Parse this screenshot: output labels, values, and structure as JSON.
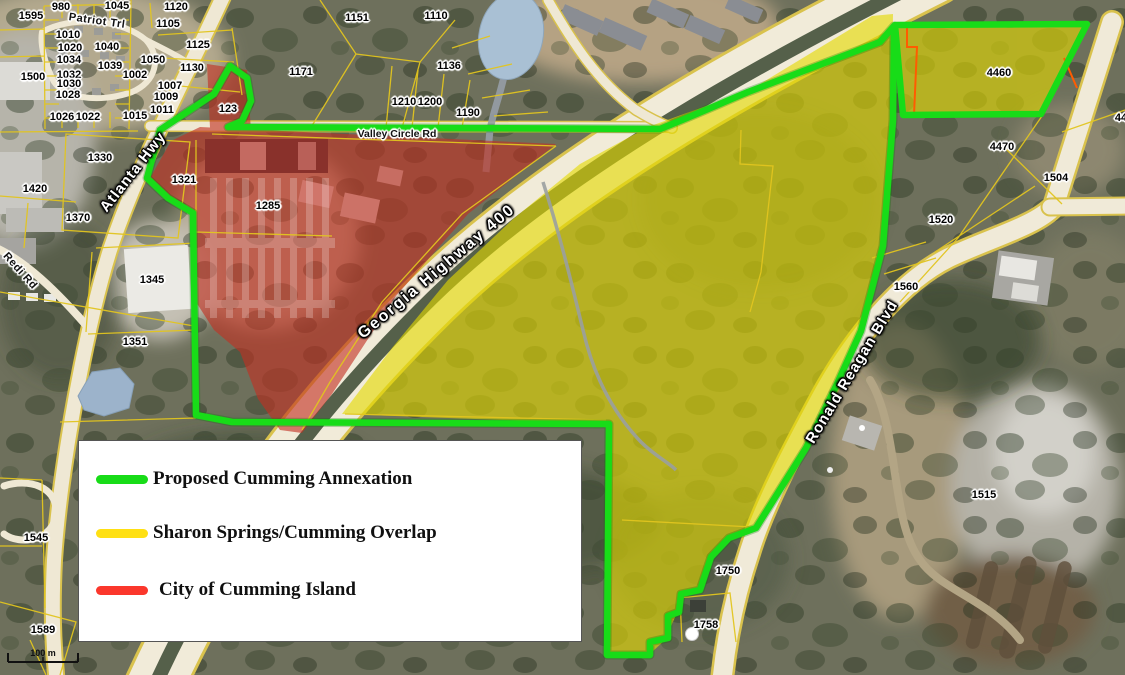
{
  "map": {
    "colors": {
      "annexation_green": "#18dc18",
      "overlap_yellow": "#ffe013",
      "island_red": "#fb372c",
      "overlay_yellow_fill": "#e3da00",
      "overlay_red_fill": "#c23122",
      "island_outline_orange": "#ff5c00",
      "parcel_line": "#e2c51f"
    },
    "legend": {
      "items": [
        {
          "id": "annexation",
          "label": "Proposed Cumming Annexation"
        },
        {
          "id": "overlap",
          "label": "Sharon Springs/Cumming Overlap"
        },
        {
          "id": "island",
          "label": "City of Cumming Island"
        }
      ]
    },
    "scale_bar": {
      "label": "100 m"
    },
    "road_labels": [
      {
        "text": "Atlanta Hwy",
        "x": 133,
        "y": 172,
        "rot": -52,
        "size": 15,
        "style": "light",
        "spacing": 1
      },
      {
        "text": "Georgia Highway 400",
        "x": 437,
        "y": 272,
        "rot": -40,
        "size": 16,
        "style": "light",
        "spacing": 2
      },
      {
        "text": "Ronald Reagan Blvd",
        "x": 852,
        "y": 372,
        "rot": -59,
        "size": 15,
        "style": "light",
        "spacing": 1
      },
      {
        "text": "Valley Circle Rd",
        "x": 397,
        "y": 134,
        "rot": 0,
        "size": 10.5,
        "style": "dark",
        "spacing": 0
      },
      {
        "text": "Patriot Trl",
        "x": 97,
        "y": 21,
        "rot": 8,
        "size": 11,
        "style": "dark",
        "spacing": 0.5
      },
      {
        "text": "Redi Rd",
        "x": 20,
        "y": 271,
        "rot": 48,
        "size": 11,
        "style": "dark",
        "spacing": 0.5
      }
    ],
    "parcel_labels": [
      {
        "text": "980",
        "x": 61,
        "y": 7
      },
      {
        "text": "1045",
        "x": 117,
        "y": 6
      },
      {
        "text": "1120",
        "x": 176,
        "y": 7
      },
      {
        "text": "1595",
        "x": 31,
        "y": 16
      },
      {
        "text": "1105",
        "x": 168,
        "y": 24
      },
      {
        "text": "1010",
        "x": 68,
        "y": 35
      },
      {
        "text": "1125",
        "x": 198,
        "y": 45
      },
      {
        "text": "1020",
        "x": 70,
        "y": 48
      },
      {
        "text": "1040",
        "x": 107,
        "y": 47
      },
      {
        "text": "1034",
        "x": 69,
        "y": 60
      },
      {
        "text": "1050",
        "x": 153,
        "y": 60
      },
      {
        "text": "1039",
        "x": 110,
        "y": 66
      },
      {
        "text": "1130",
        "x": 192,
        "y": 68
      },
      {
        "text": "1500",
        "x": 33,
        "y": 77
      },
      {
        "text": "1002",
        "x": 135,
        "y": 75
      },
      {
        "text": "1032",
        "x": 69,
        "y": 75
      },
      {
        "text": "1030",
        "x": 69,
        "y": 84
      },
      {
        "text": "1007",
        "x": 170,
        "y": 86
      },
      {
        "text": "1028",
        "x": 68,
        "y": 95
      },
      {
        "text": "1009",
        "x": 166,
        "y": 97
      },
      {
        "text": "1011",
        "x": 162,
        "y": 110
      },
      {
        "text": "1026",
        "x": 62,
        "y": 117
      },
      {
        "text": "1022",
        "x": 88,
        "y": 117
      },
      {
        "text": "1015",
        "x": 135,
        "y": 116
      },
      {
        "text": "123",
        "x": 228,
        "y": 109
      },
      {
        "text": "1330",
        "x": 100,
        "y": 158
      },
      {
        "text": "1321",
        "x": 184,
        "y": 180
      },
      {
        "text": "1420",
        "x": 35,
        "y": 189
      },
      {
        "text": "1285",
        "x": 268,
        "y": 206
      },
      {
        "text": "1370",
        "x": 78,
        "y": 218
      },
      {
        "text": "1345",
        "x": 152,
        "y": 280
      },
      {
        "text": "1351",
        "x": 135,
        "y": 342
      },
      {
        "text": "1545",
        "x": 36,
        "y": 538
      },
      {
        "text": "1589",
        "x": 43,
        "y": 630
      },
      {
        "text": "1151",
        "x": 357,
        "y": 18
      },
      {
        "text": "1110",
        "x": 436,
        "y": 16
      },
      {
        "text": "1171",
        "x": 301,
        "y": 72
      },
      {
        "text": "1136",
        "x": 449,
        "y": 66
      },
      {
        "text": "1210",
        "x": 404,
        "y": 102
      },
      {
        "text": "1200",
        "x": 430,
        "y": 102
      },
      {
        "text": "1190",
        "x": 468,
        "y": 113
      },
      {
        "text": "4460",
        "x": 999,
        "y": 73
      },
      {
        "text": "44",
        "x": 1121,
        "y": 118
      },
      {
        "text": "4470",
        "x": 1002,
        "y": 147
      },
      {
        "text": "1504",
        "x": 1056,
        "y": 178
      },
      {
        "text": "1520",
        "x": 941,
        "y": 220
      },
      {
        "text": "1560",
        "x": 906,
        "y": 287
      },
      {
        "text": "1515",
        "x": 984,
        "y": 495
      },
      {
        "text": "1750",
        "x": 728,
        "y": 571
      },
      {
        "text": "1758",
        "x": 706,
        "y": 625
      }
    ]
  }
}
